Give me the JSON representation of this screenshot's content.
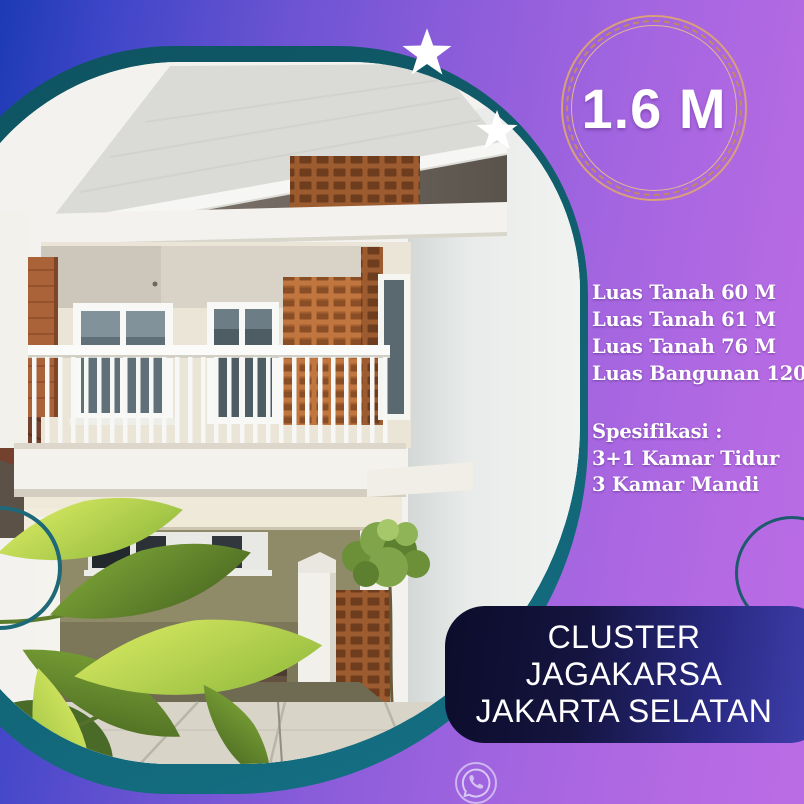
{
  "poster": {
    "price_badge": {
      "label": "1.6 M"
    },
    "land_specs": [
      "Luas Tanah 60 M",
      "Luas Tanah 61 M",
      "Luas Tanah 76 M",
      "Luas Bangunan 120 M"
    ],
    "spec_heading": "Spesifikasi :",
    "spec_items": [
      "3+1 Kamar Tidur",
      "3 Kamar Mandi"
    ],
    "location": [
      "CLUSTER",
      "JAGAKARSA",
      "JAKARTA SELATAN"
    ],
    "icons": {
      "whatsapp": "whatsapp-icon",
      "star_large": "sparkle-star-icon",
      "star_small": "sparkle-star-icon",
      "ring_left": "circle-outline-decoration",
      "ring_right": "circle-outline-decoration"
    },
    "colors": {
      "background_left": "#1d3ab4",
      "background_right": "#ba6ce4",
      "teal_frame": "#11606f",
      "card_dark": "#0c0c2b",
      "card_indigo": "#4242b2",
      "badge_ring": "#c48862",
      "text": "#ffffff"
    }
  }
}
